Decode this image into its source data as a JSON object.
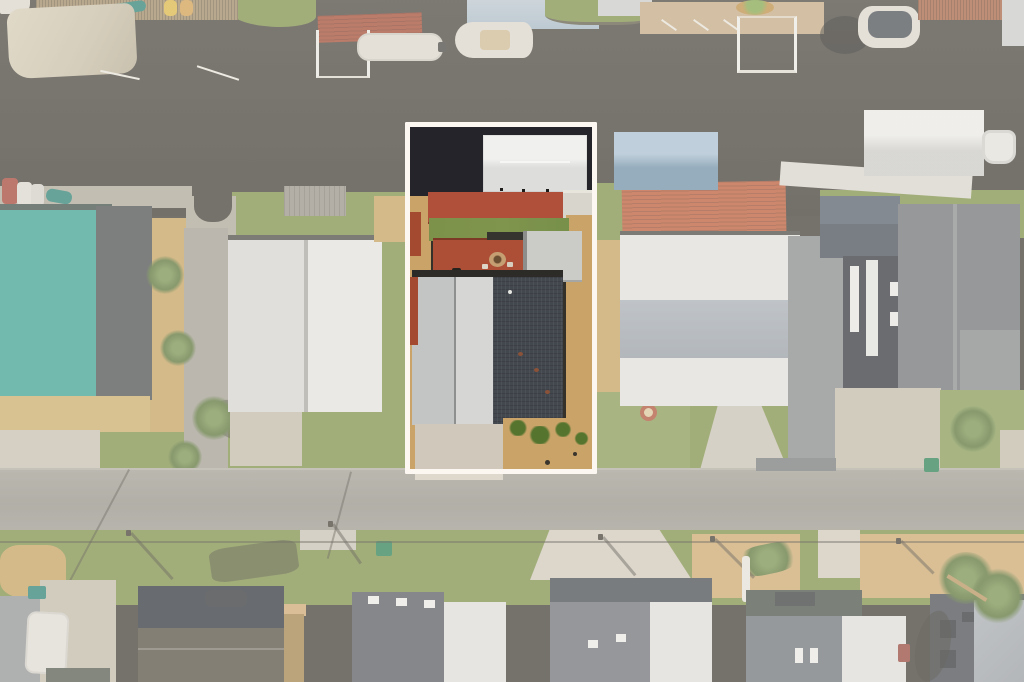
{
  "scene_type": "aerial-photo",
  "highlight": {
    "x": 405,
    "y": 122,
    "width": 192,
    "height": 352,
    "border_px": 5
  },
  "colors": {
    "water": "#34312a",
    "water-deep": "#25242a",
    "grass": "#76893f",
    "lawn": "#7f944d",
    "sand": "#c29b56",
    "mulch": "#c9a368",
    "concrete": "#beb6a6",
    "concrete-bright": "#cfc8bb",
    "road": "#8f8c84",
    "white-roof": "#dededb",
    "white-roof-bright": "#e9e9e7",
    "metal-light": "#d6d7d5",
    "metal-mid": "#c3c5c4",
    "charcoal-roof": "#43474e",
    "gray-shingle": "#66696d",
    "slate-roof": "#20262f",
    "dark-house": "#23282f",
    "brown-roof": "#4a4337",
    "teal-roof": "#2f9a8c",
    "teal-dark-edge": "#34443f",
    "blue-roof": "#6f97b5",
    "salmon-roof": "#b5502c",
    "rust-dock": "#a05a3a",
    "red-deck": "#b0503a",
    "red-strip": "#a34a31",
    "red-canopy": "#9c3f28",
    "wood-dock": "#97805c",
    "wood-stairs": "#9c7a42",
    "boat-white": "#d8d4ca",
    "canvas": "#c4baa2",
    "gravel": "#7f8285",
    "construction-dark": "#3f4345",
    "palm": "#4e6b2c",
    "palm-light": "#6f8a45",
    "shrub": "#55752f",
    "bin-green": "#1f7a4b",
    "bin-teal": "#1f7a6e",
    "firepit-ring": "#a84a2e",
    "car-red": "#9e392c",
    "car-dark": "#23282c",
    "window-dark": "#24272c",
    "seawall": "#a8a193",
    "path": "#9b978c",
    "border": "#fcf8f1",
    "wash": "rgba(251,249,244,0.33)"
  }
}
